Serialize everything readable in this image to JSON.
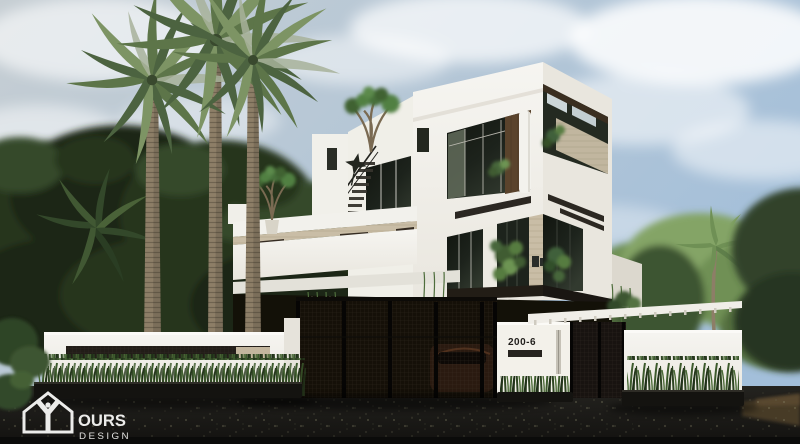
{
  "watermark": {
    "icon": "house-y-logo-icon",
    "line1": "OURS",
    "line2": "DESIGN"
  },
  "address_sign": {
    "number": "200-6"
  },
  "scene": {
    "type": "architectural-exterior-render",
    "elements": [
      "sky with soft clouds",
      "dense dark trees in left background",
      "light tropical trees in right background",
      "three tall date palms",
      "modern 3-storey white villa with chamfered corner",
      "rooftop frangipani trees in pots",
      "exterior staircase with dark railing",
      "star-shaped rooftop sculpture",
      "glass facades with dark frames",
      "wood and travertine accent panels",
      "balcony plants and hanging vines",
      "white perimeter wall with ventilation slot",
      "dark metal mesh driveway gate",
      "car silhouette behind gate",
      "white entrance pillar with house number",
      "white slatted pergola over side court",
      "ornamental grass planters",
      "dark asphalt road with fallen leaves",
      "designer watermark logo bottom-left"
    ]
  },
  "colors": {
    "sky_top": "#c6ced3",
    "sky_right": "#a3bfda",
    "cloud": "#ffffff",
    "tree_dark": "#26341f",
    "tree_mid": "#35482a",
    "tree_deep": "#1c2817",
    "tree_light": "#6f9055",
    "tree_lighter": "#84a466",
    "palm_trunk": "#8d7e67",
    "palm_band": "#6f6350",
    "frond_dark": "#4c6340",
    "frond_mid": "#5d7549",
    "frond_light": "#7d9464",
    "frond_silver": "#a7b29a",
    "house_white": "#f6f5f1",
    "house_shade": "#e9e6de",
    "house_dark_face": "#dcd8ce",
    "travertine": "#c9bda6",
    "wood": "#5a432c",
    "wood_dark": "#3a2e20",
    "glass_dark": "#1d231c",
    "glass_light": "#66705f",
    "frame_light": "#cfccc3",
    "soffit": "#221d16",
    "wall_white": "#edebe4",
    "gate_metal": "#151008",
    "mesh_line": "#4a4136",
    "car_body": "#2a1a10",
    "pillar_white": "#f3f1ea",
    "sign_text": "#211f1c",
    "pergola_white": "#f0eee8",
    "grass_dark": "#2e4522",
    "grass_light": "#4a6a36",
    "planter": "#141310",
    "road": "#1b1a17",
    "road_bottom": "#0b0b0a",
    "dirt": "#473a28",
    "speckle": "#8f8d6e",
    "logo_white": "#f5f5f3"
  }
}
